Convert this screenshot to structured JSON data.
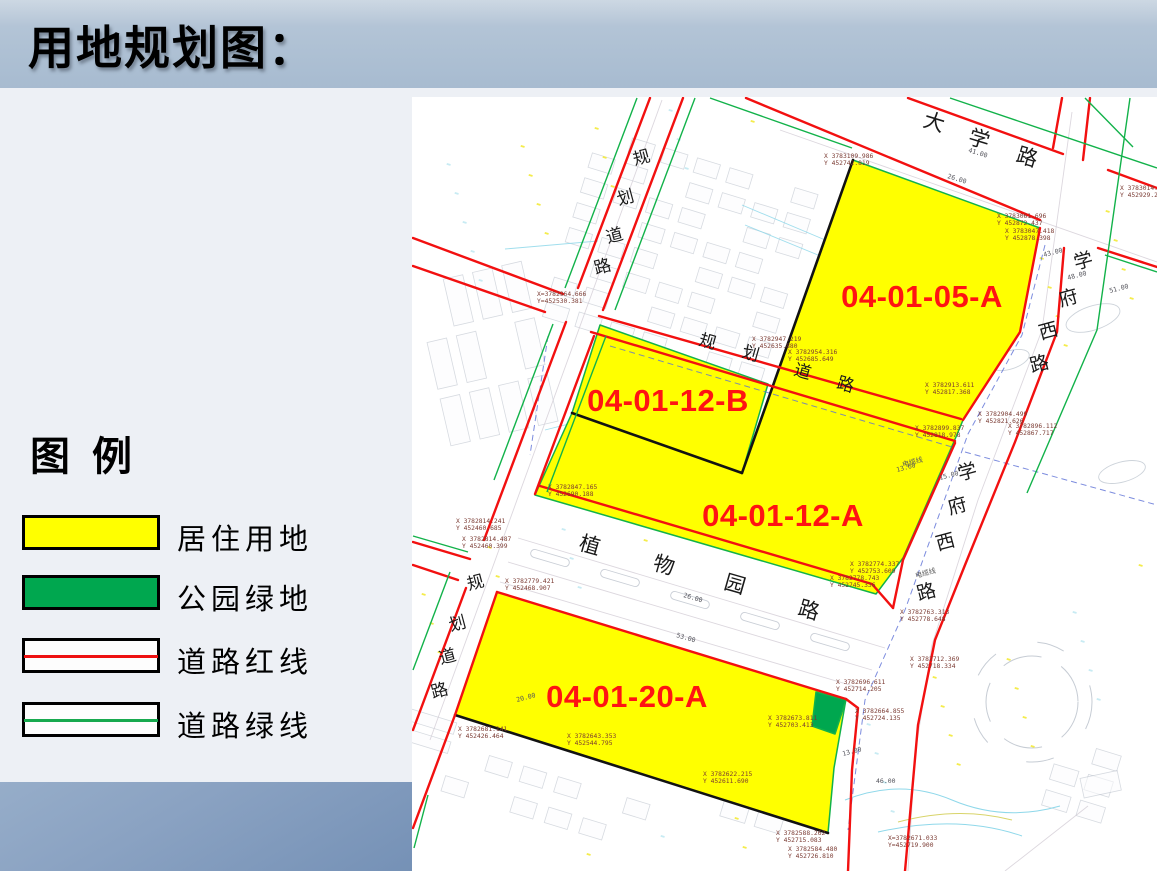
{
  "slide": {
    "title": "用地规划图："
  },
  "legend": {
    "title": "图 例",
    "items": [
      {
        "name": "residential",
        "label": "居住用地",
        "swatch": "fill",
        "color": "#ffff00"
      },
      {
        "name": "park-green",
        "label": "公园绿地",
        "swatch": "fill",
        "color": "#00a74f"
      },
      {
        "name": "road-red-line",
        "label": "道路红线",
        "swatch": "line",
        "color": "#ee1111"
      },
      {
        "name": "road-green-line",
        "label": "道路绿线",
        "swatch": "line",
        "color": "#17a94e"
      }
    ]
  },
  "map": {
    "parcel_labels": [
      {
        "id": "04-01-05-A",
        "x": 922,
        "y": 296
      },
      {
        "id": "04-01-12-B",
        "x": 668,
        "y": 400
      },
      {
        "id": "04-01-12-A",
        "x": 783,
        "y": 515
      },
      {
        "id": "04-01-20-A",
        "x": 627,
        "y": 696
      }
    ],
    "road_names": [
      {
        "name": "大学路",
        "rot": 17,
        "size": 21,
        "chars": [
          {
            "c": "大",
            "x": 932,
            "y": 129
          },
          {
            "c": "学",
            "x": 977,
            "y": 146
          },
          {
            "c": "路",
            "x": 1025,
            "y": 164
          }
        ]
      },
      {
        "name": "学府西路-上",
        "rot": -15,
        "size": 19,
        "chars": [
          {
            "c": "学",
            "x": 1085,
            "y": 267
          },
          {
            "c": "府",
            "x": 1070,
            "y": 304
          },
          {
            "c": "西",
            "x": 1050,
            "y": 337
          },
          {
            "c": "路",
            "x": 1041,
            "y": 370
          }
        ]
      },
      {
        "name": "学府西路-下",
        "rot": -15,
        "size": 19,
        "chars": [
          {
            "c": "学",
            "x": 969,
            "y": 478
          },
          {
            "c": "府",
            "x": 959,
            "y": 512
          },
          {
            "c": "西",
            "x": 947,
            "y": 548
          },
          {
            "c": "路",
            "x": 928,
            "y": 598
          }
        ]
      },
      {
        "name": "规划道路-左上",
        "rot": -15,
        "size": 17,
        "chars": [
          {
            "c": "规",
            "x": 643,
            "y": 163
          },
          {
            "c": "划",
            "x": 627,
            "y": 203
          },
          {
            "c": "道",
            "x": 616,
            "y": 241
          },
          {
            "c": "路",
            "x": 604,
            "y": 272
          }
        ]
      },
      {
        "name": "规划道路-左下",
        "rot": -15,
        "size": 17,
        "chars": [
          {
            "c": "规",
            "x": 477,
            "y": 588
          },
          {
            "c": "划",
            "x": 459,
            "y": 629
          },
          {
            "c": "道",
            "x": 449,
            "y": 662
          },
          {
            "c": "路",
            "x": 441,
            "y": 696
          }
        ]
      },
      {
        "name": "规划道路-中",
        "rot": 16,
        "size": 17,
        "chars": [
          {
            "c": "规",
            "x": 706,
            "y": 347
          },
          {
            "c": "划",
            "x": 749,
            "y": 359
          },
          {
            "c": "道",
            "x": 801,
            "y": 377
          },
          {
            "c": "路",
            "x": 844,
            "y": 390
          }
        ]
      },
      {
        "name": "植物园路",
        "rot": 16,
        "size": 21,
        "chars": [
          {
            "c": "植",
            "x": 588,
            "y": 552
          },
          {
            "c": "物",
            "x": 662,
            "y": 572
          },
          {
            "c": "园",
            "x": 733,
            "y": 591
          },
          {
            "c": "路",
            "x": 807,
            "y": 617
          }
        ]
      }
    ],
    "coordinate_labels": [
      {
        "x": 824,
        "y": 158,
        "l1": "X 3783109.986",
        "l2": "Y 452742.819"
      },
      {
        "x": 1120,
        "y": 190,
        "l1": "X 3783014.666",
        "l2": "Y 452929.283"
      },
      {
        "x": 997,
        "y": 218,
        "l1": "X 3783061.696",
        "l2": "Y 452872.437"
      },
      {
        "x": 1005,
        "y": 233,
        "l1": "X 3783047.418",
        "l2": "Y 452878.398"
      },
      {
        "x": 537,
        "y": 296,
        "l1": "X=3782964.666",
        "l2": "Y=452530.381"
      },
      {
        "x": 752,
        "y": 341,
        "l1": "X 3782947.219",
        "l2": "Y 452635.880"
      },
      {
        "x": 788,
        "y": 354,
        "l1": "X 3782954.316",
        "l2": "Y 452685.649"
      },
      {
        "x": 925,
        "y": 387,
        "l1": "X 3782913.611",
        "l2": "Y 452817.368"
      },
      {
        "x": 978,
        "y": 416,
        "l1": "X 3782904.499",
        "l2": "Y 452821.626"
      },
      {
        "x": 1008,
        "y": 428,
        "l1": "X 3782896.112",
        "l2": "Y 452867.717"
      },
      {
        "x": 915,
        "y": 430,
        "l1": "X 3782899.837",
        "l2": "Y 452818.978"
      },
      {
        "x": 548,
        "y": 489,
        "l1": "X 3782847.165",
        "l2": "Y 452690.188"
      },
      {
        "x": 456,
        "y": 523,
        "l1": "X 3782814.241",
        "l2": "Y 452460.685"
      },
      {
        "x": 462,
        "y": 541,
        "l1": "X 3782814.487",
        "l2": "Y 452460.399"
      },
      {
        "x": 850,
        "y": 566,
        "l1": "X 3782774.337",
        "l2": "Y 452753.609"
      },
      {
        "x": 830,
        "y": 580,
        "l1": "X 3782778.743",
        "l2": "Y 452745.336"
      },
      {
        "x": 505,
        "y": 583,
        "l1": "X 3782779.421",
        "l2": "Y 452468.907"
      },
      {
        "x": 900,
        "y": 614,
        "l1": "X 3782763.313",
        "l2": "Y 452778.648"
      },
      {
        "x": 910,
        "y": 661,
        "l1": "X 3782712.369",
        "l2": "Y 452718.334"
      },
      {
        "x": 836,
        "y": 684,
        "l1": "X 3782696.611",
        "l2": "Y 452714.205"
      },
      {
        "x": 855,
        "y": 713,
        "l1": "X 3782664.855",
        "l2": "Y 452724.135"
      },
      {
        "x": 768,
        "y": 720,
        "l1": "X 3782673.811",
        "l2": "Y 452703.413"
      },
      {
        "x": 458,
        "y": 731,
        "l1": "X 3782681.141",
        "l2": "Y 452426.464"
      },
      {
        "x": 567,
        "y": 738,
        "l1": "X 3782643.353",
        "l2": "Y 452544.795"
      },
      {
        "x": 703,
        "y": 776,
        "l1": "X 3782622.215",
        "l2": "Y 452611.690"
      },
      {
        "x": 776,
        "y": 835,
        "l1": "X 3782588.262",
        "l2": "Y 452715.083"
      },
      {
        "x": 788,
        "y": 851,
        "l1": "X 3782584.480",
        "l2": "Y 452726.810"
      },
      {
        "x": 888,
        "y": 840,
        "l1": "X=3782671.033",
        "l2": "Y=452719.900"
      }
    ],
    "distance_labels": [
      {
        "t": "41.00",
        "x": 968,
        "y": 152,
        "r": 17
      },
      {
        "t": "26.00",
        "x": 947,
        "y": 178,
        "r": 17
      },
      {
        "t": "43.00",
        "x": 1044,
        "y": 257,
        "r": -15
      },
      {
        "t": "48.00",
        "x": 1068,
        "y": 280,
        "r": -15
      },
      {
        "t": "51.00",
        "x": 1110,
        "y": 293,
        "r": -15
      },
      {
        "t": "13.60",
        "x": 897,
        "y": 472,
        "r": -15
      },
      {
        "t": "15.00",
        "x": 940,
        "y": 480,
        "r": -15
      },
      {
        "t": "26.00",
        "x": 683,
        "y": 597,
        "r": 16
      },
      {
        "t": "53.00",
        "x": 676,
        "y": 637,
        "r": 16
      },
      {
        "t": "20.00",
        "x": 517,
        "y": 702,
        "r": -15
      },
      {
        "t": "13.00",
        "x": 843,
        "y": 756,
        "r": -15
      },
      {
        "t": "46.00",
        "x": 876,
        "y": 783,
        "r": 0
      }
    ],
    "annotations": [
      {
        "t": "电缆线",
        "x": 903,
        "y": 467,
        "r": -15
      },
      {
        "t": "电缆线",
        "x": 916,
        "y": 578,
        "r": -15
      }
    ],
    "colors": {
      "parcel_yellow": "#ffff00",
      "park_green": "#00a74f",
      "road_red": "#f21010",
      "road_green": "#12b24a",
      "boundary_black": "#121212",
      "label_red": "#ff1313",
      "coord_text": "#7a3a32",
      "distance_text": "#54545c",
      "blue_dash": "#5b6fd6",
      "cyan": "#8fd8ea"
    }
  }
}
